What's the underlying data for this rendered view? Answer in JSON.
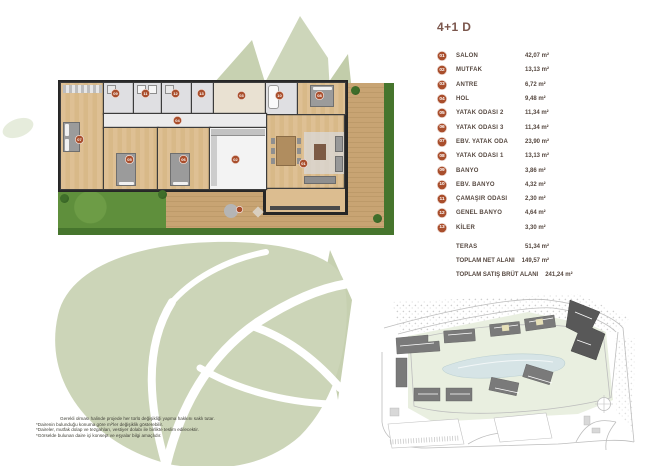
{
  "title": "4+1 D",
  "legend": {
    "rooms": [
      {
        "num": "01",
        "label": "SALON",
        "area": "42,07 m²"
      },
      {
        "num": "02",
        "label": "MUTFAK",
        "area": "13,13 m²"
      },
      {
        "num": "03",
        "label": "ANTRE",
        "area": "6,72 m²"
      },
      {
        "num": "04",
        "label": "HOL",
        "area": "9,48 m²"
      },
      {
        "num": "05",
        "label": "YATAK ODASI 2",
        "area": "11,34 m²"
      },
      {
        "num": "06",
        "label": "YATAK ODASI 3",
        "area": "11,34 m²"
      },
      {
        "num": "07",
        "label": "EBV. YATAK ODA",
        "area": "23,90 m²"
      },
      {
        "num": "08",
        "label": "YATAK ODASI 1",
        "area": "13,13 m²"
      },
      {
        "num": "09",
        "label": "BANYO",
        "area": "3,86 m²"
      },
      {
        "num": "10",
        "label": "EBV. BANYO",
        "area": "4,32 m²"
      },
      {
        "num": "11",
        "label": "ÇAMAŞIR ODASI",
        "area": "2,30 m²"
      },
      {
        "num": "12",
        "label": "GENEL BANYO",
        "area": "4,64 m²"
      },
      {
        "num": "13",
        "label": "KİLER",
        "area": "3,30 m²"
      }
    ],
    "teras": {
      "label": "TERAS",
      "area": "51,34 m²"
    },
    "totals": [
      {
        "label": "TOPLAM NET ALANI",
        "area": "149,57 m²"
      },
      {
        "label": "TOPLAM SATIŞ BRÜT ALANI",
        "area": "241,24 m²"
      }
    ]
  },
  "disclaimer": {
    "lines": [
      "Gerekli olması halinde projede her türlü değişikliği yapma hakkını saklı tutar.",
      "*Dairenin bulunduğu konuma göre m²'ler değişiklik gösterebilir.",
      "*Daireler, mutfak dolap ve tezgahları, vestiyer dolabı ile birlikte teslim edilecektir.",
      "*Görselde bulunan daire içi konsept ve eşyalar bilgi amaçlıdır."
    ]
  },
  "floor_plan": {
    "description": "4+1 daire kat planı, teraslı"
  },
  "site_plan": {
    "description": "Vaziyet planı – vurgulanan blok"
  },
  "colors": {
    "badge": "#a94e2c",
    "title": "#7b564c",
    "leaf_watermark": "#ccd5b8",
    "lawn": "#5f8f3c",
    "wood_floor": "#dcbd90",
    "deck": "#c6a271",
    "highlight_building": "#585858"
  }
}
